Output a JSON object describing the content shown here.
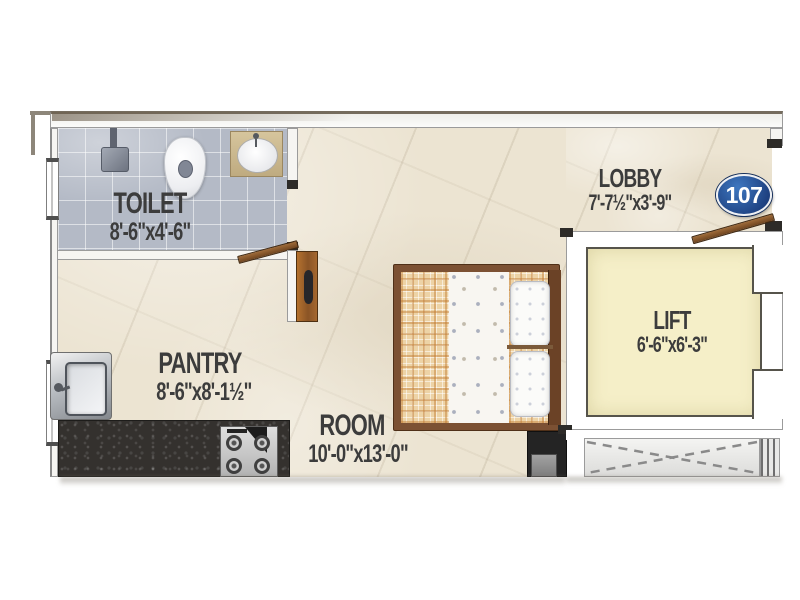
{
  "unit_badge": {
    "number": "107"
  },
  "rooms": {
    "toilet": {
      "label": "TOILET",
      "dims": "8'-6\"x4'-6\""
    },
    "pantry": {
      "label": "PANTRY",
      "dims": "8'-6\"x8'-1½\""
    },
    "room": {
      "label": "ROOM",
      "dims": "10'-0\"x13'-0\""
    },
    "lobby": {
      "label": "LOBBY",
      "dims": "7'-7½\"x3'-9\""
    },
    "lift": {
      "label": "LIFT",
      "dims": "6'-6\"x6'-3\""
    }
  },
  "fixtures": {
    "shower": "shower-head-icon",
    "wc": "toilet-wc-icon",
    "washbasin": "washbasin-icon",
    "kitchen_sink": "kitchen-sink-icon",
    "stove": "gas-stove-icon",
    "counter": "granite-counter",
    "bed": "double-bed",
    "pillows": "pillows",
    "bedside": "bedside-table",
    "wardrobe": "wardrobe-panel",
    "toilet_door": "toilet-door",
    "entrance_door": "entrance-door",
    "windows": "window-symbol",
    "duct": "duct-cross-marking",
    "stairs": "stair-edge-lines"
  },
  "colors": {
    "floor": "#ece4d2",
    "tile": "#b4bac6",
    "lift": "#f5efc8",
    "granite": "#34312e",
    "wood": "#8a5a2c",
    "badge_blue": "#27508f",
    "wall_outline": "#9b9b9b",
    "text": "#3c3c3c"
  }
}
